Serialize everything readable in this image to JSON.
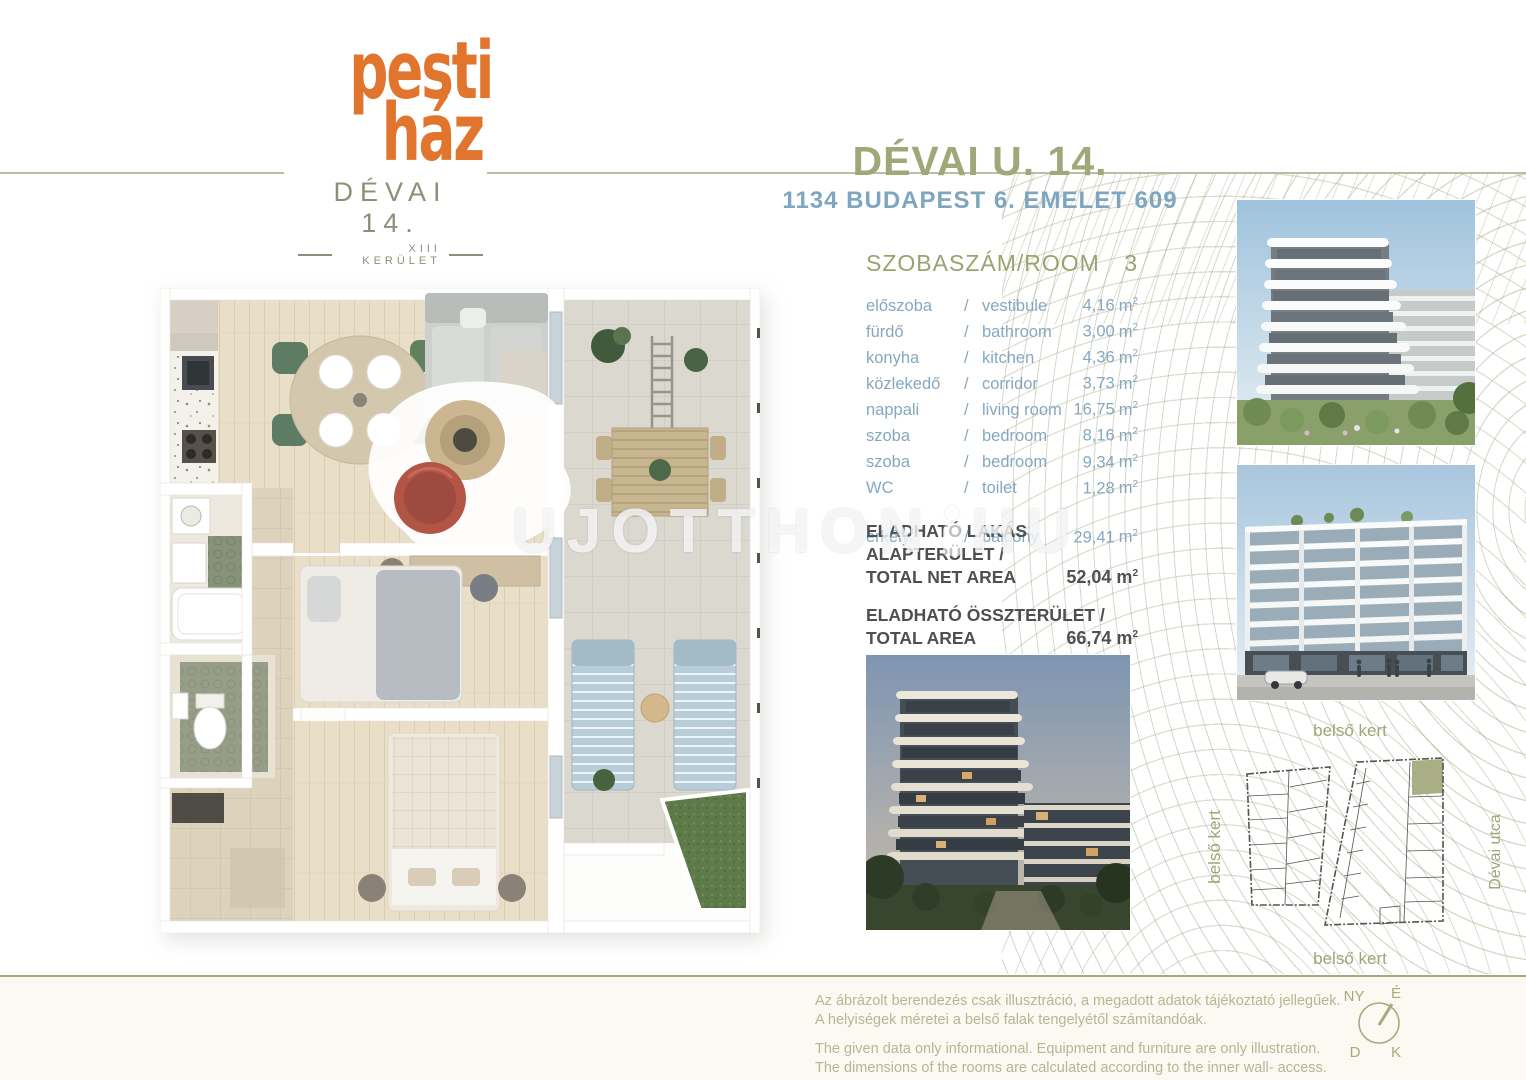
{
  "brand": {
    "logo_line1": "pesti",
    "logo_line2": "ház",
    "logo_sub": "DÉVAI 14.",
    "logo_district": "XIII  KERÜLET",
    "orange": "#e2752e",
    "olive": "#a2a779",
    "blue": "#7ea6c0"
  },
  "header": {
    "title": "DÉVAI U. 14.",
    "subtitle": "1134  BUDAPEST 6. EMELET 609"
  },
  "rooms": {
    "header_label": "SZOBASZÁM/ROOM",
    "header_value": "3",
    "sep": "/",
    "unit": "m",
    "sup": "2",
    "items": [
      {
        "hu": "előszoba",
        "en": "vestibule",
        "area": "4,16"
      },
      {
        "hu": "fürdő",
        "en": "bathroom",
        "area": "3,00"
      },
      {
        "hu": "konyha",
        "en": "kitchen",
        "area": "4,36"
      },
      {
        "hu": "közlekedő",
        "en": "corridor",
        "area": "3,73"
      },
      {
        "hu": "nappali",
        "en": "living room",
        "area": "16,75"
      },
      {
        "hu": "szoba",
        "en": "bedroom",
        "area": "8,16"
      },
      {
        "hu": "szoba",
        "en": "bedroom",
        "area": "9,34"
      },
      {
        "hu": "WC",
        "en": "toilet",
        "area": "1,28"
      }
    ],
    "balcony": {
      "hu": "erkély",
      "en": "balcony",
      "area": "29,41"
    }
  },
  "totals": [
    {
      "line1": "ELADHATÓ LAKÁS ALAPTERÜLET /",
      "line2": "TOTAL  NET AREA",
      "value": "52,04"
    },
    {
      "line1": "ELADHATÓ ÖSSZTERÜLET /",
      "line2": "TOTAL AREA",
      "value": "66,74"
    }
  ],
  "watermark": {
    "part1": "UJOTTHON",
    "part2": "HU"
  },
  "siteplan": {
    "label_top": "belső kert",
    "label_left": "belső kert",
    "label_bottom": "belső kert",
    "label_right": "Dévai utca",
    "highlight_color": "#a9ae85"
  },
  "compass": {
    "nw": "NY",
    "n": "É",
    "s": "D",
    "e": "K"
  },
  "footer": {
    "hu1": "Az ábrázolt berendezés csak illusztráció, a megadott adatok tájékoztató jellegűek.",
    "hu2": "A helyiségek méretei a belső falak tengelyétől számítandóak.",
    "en1": "The given data only informational. Equipment and furniture are only illustration.",
    "en2": "The dimensions of the rooms are calculated according to the inner wall- access."
  }
}
